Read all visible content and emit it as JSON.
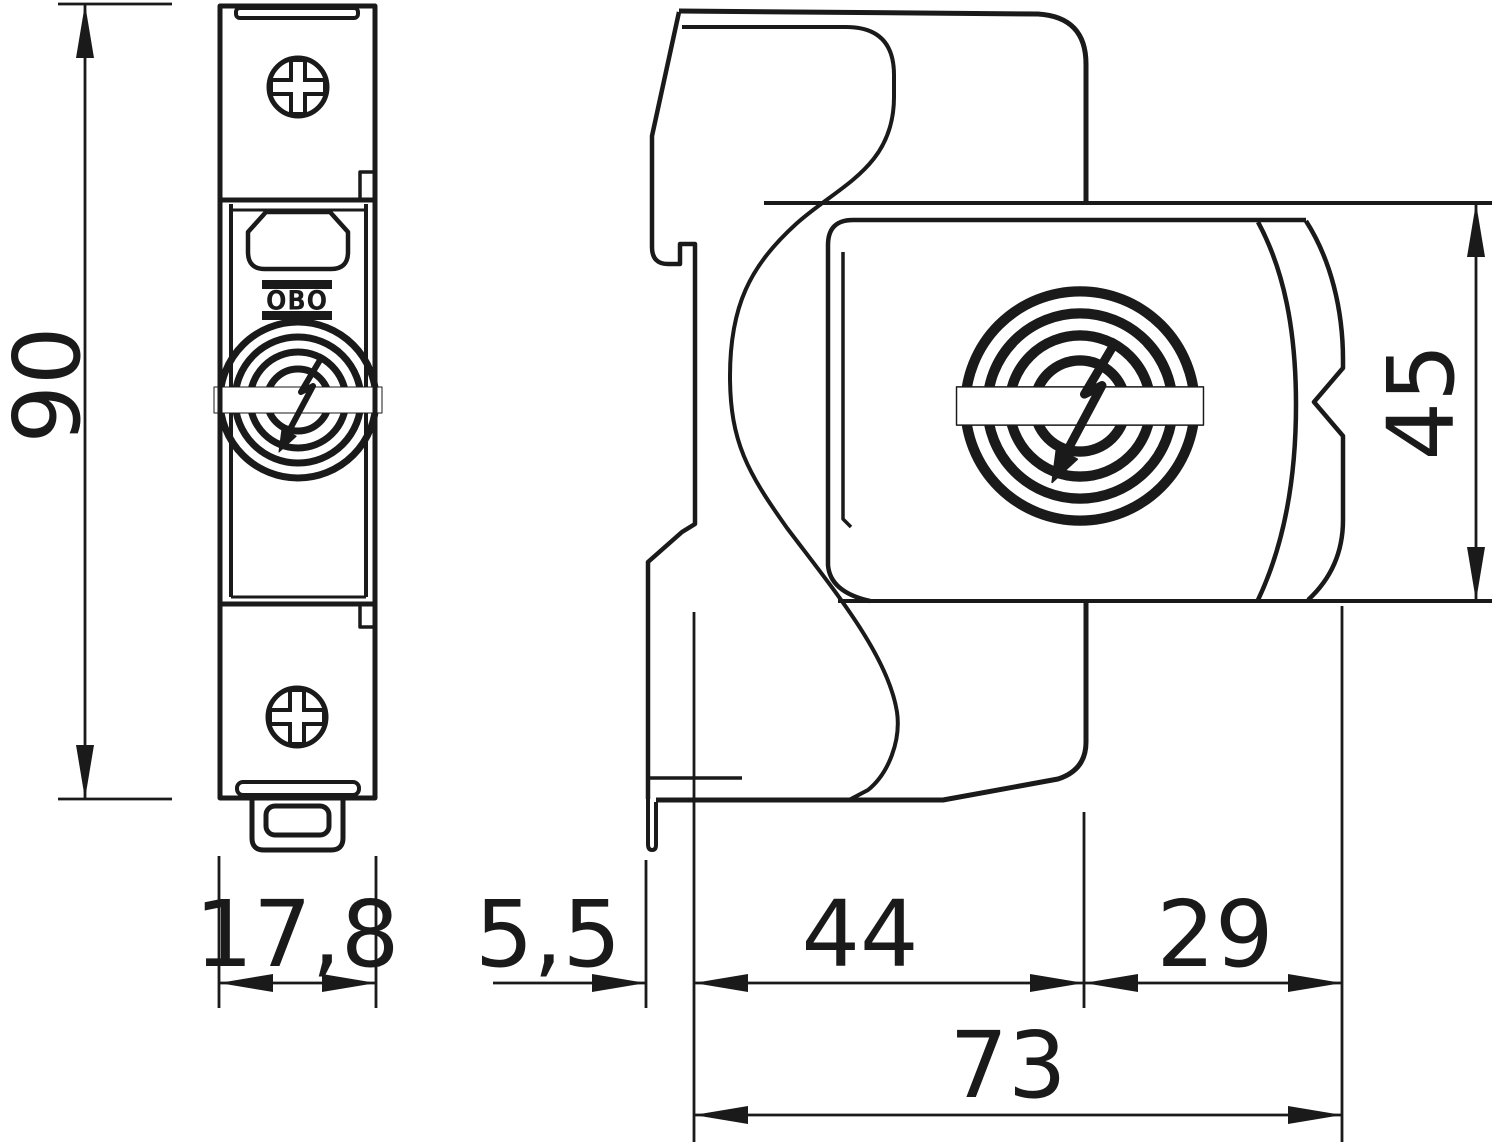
{
  "drawing": {
    "type": "technical-dimension-drawing",
    "views": [
      "front-view",
      "side-view"
    ],
    "brand_logo": "OBO",
    "colors": {
      "line": "#1a1a1a",
      "background": "#ffffff"
    }
  },
  "dimensions": {
    "front_height": "90",
    "front_width": "17,8",
    "side_height": "45",
    "rail_depth": "5,5",
    "front_depth": "44",
    "rear_depth": "29",
    "total_depth": "73"
  }
}
